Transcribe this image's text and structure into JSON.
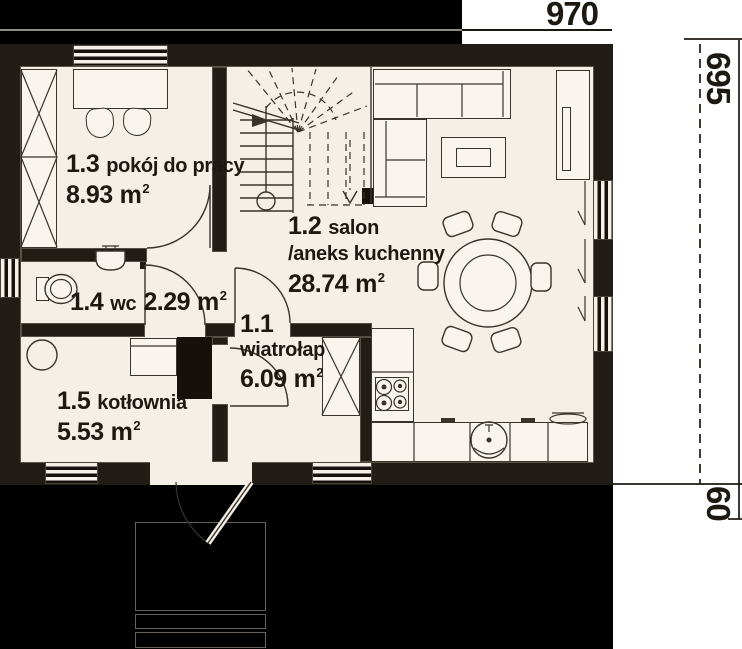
{
  "plan": {
    "dimensions": {
      "width_label": "970",
      "height_label": "695",
      "porch_label": "60"
    },
    "rooms": [
      {
        "number": "1.3",
        "name": "pokój do pracy",
        "area": "8.93",
        "unit": "m",
        "exp": "2"
      },
      {
        "number": "1.4",
        "name": "wc",
        "area": "2.29",
        "unit": "m",
        "exp": "2"
      },
      {
        "number": "1.5",
        "name": "kotłownia",
        "area": "5.53",
        "unit": "m",
        "exp": "2"
      },
      {
        "number": "1.1",
        "name": "wiatrołap",
        "area": "6.09",
        "unit": "m",
        "exp": "2"
      },
      {
        "number": "1.2",
        "name": "salon",
        "name_line2": "/aneks kuchenny",
        "area": "28.74",
        "unit": "m",
        "exp": "2"
      }
    ]
  },
  "colors": {
    "backdrop": "#000000",
    "wall": "#211c16",
    "floor": "#f5efe7",
    "line": "#39332c",
    "ink": "#1d1812"
  }
}
